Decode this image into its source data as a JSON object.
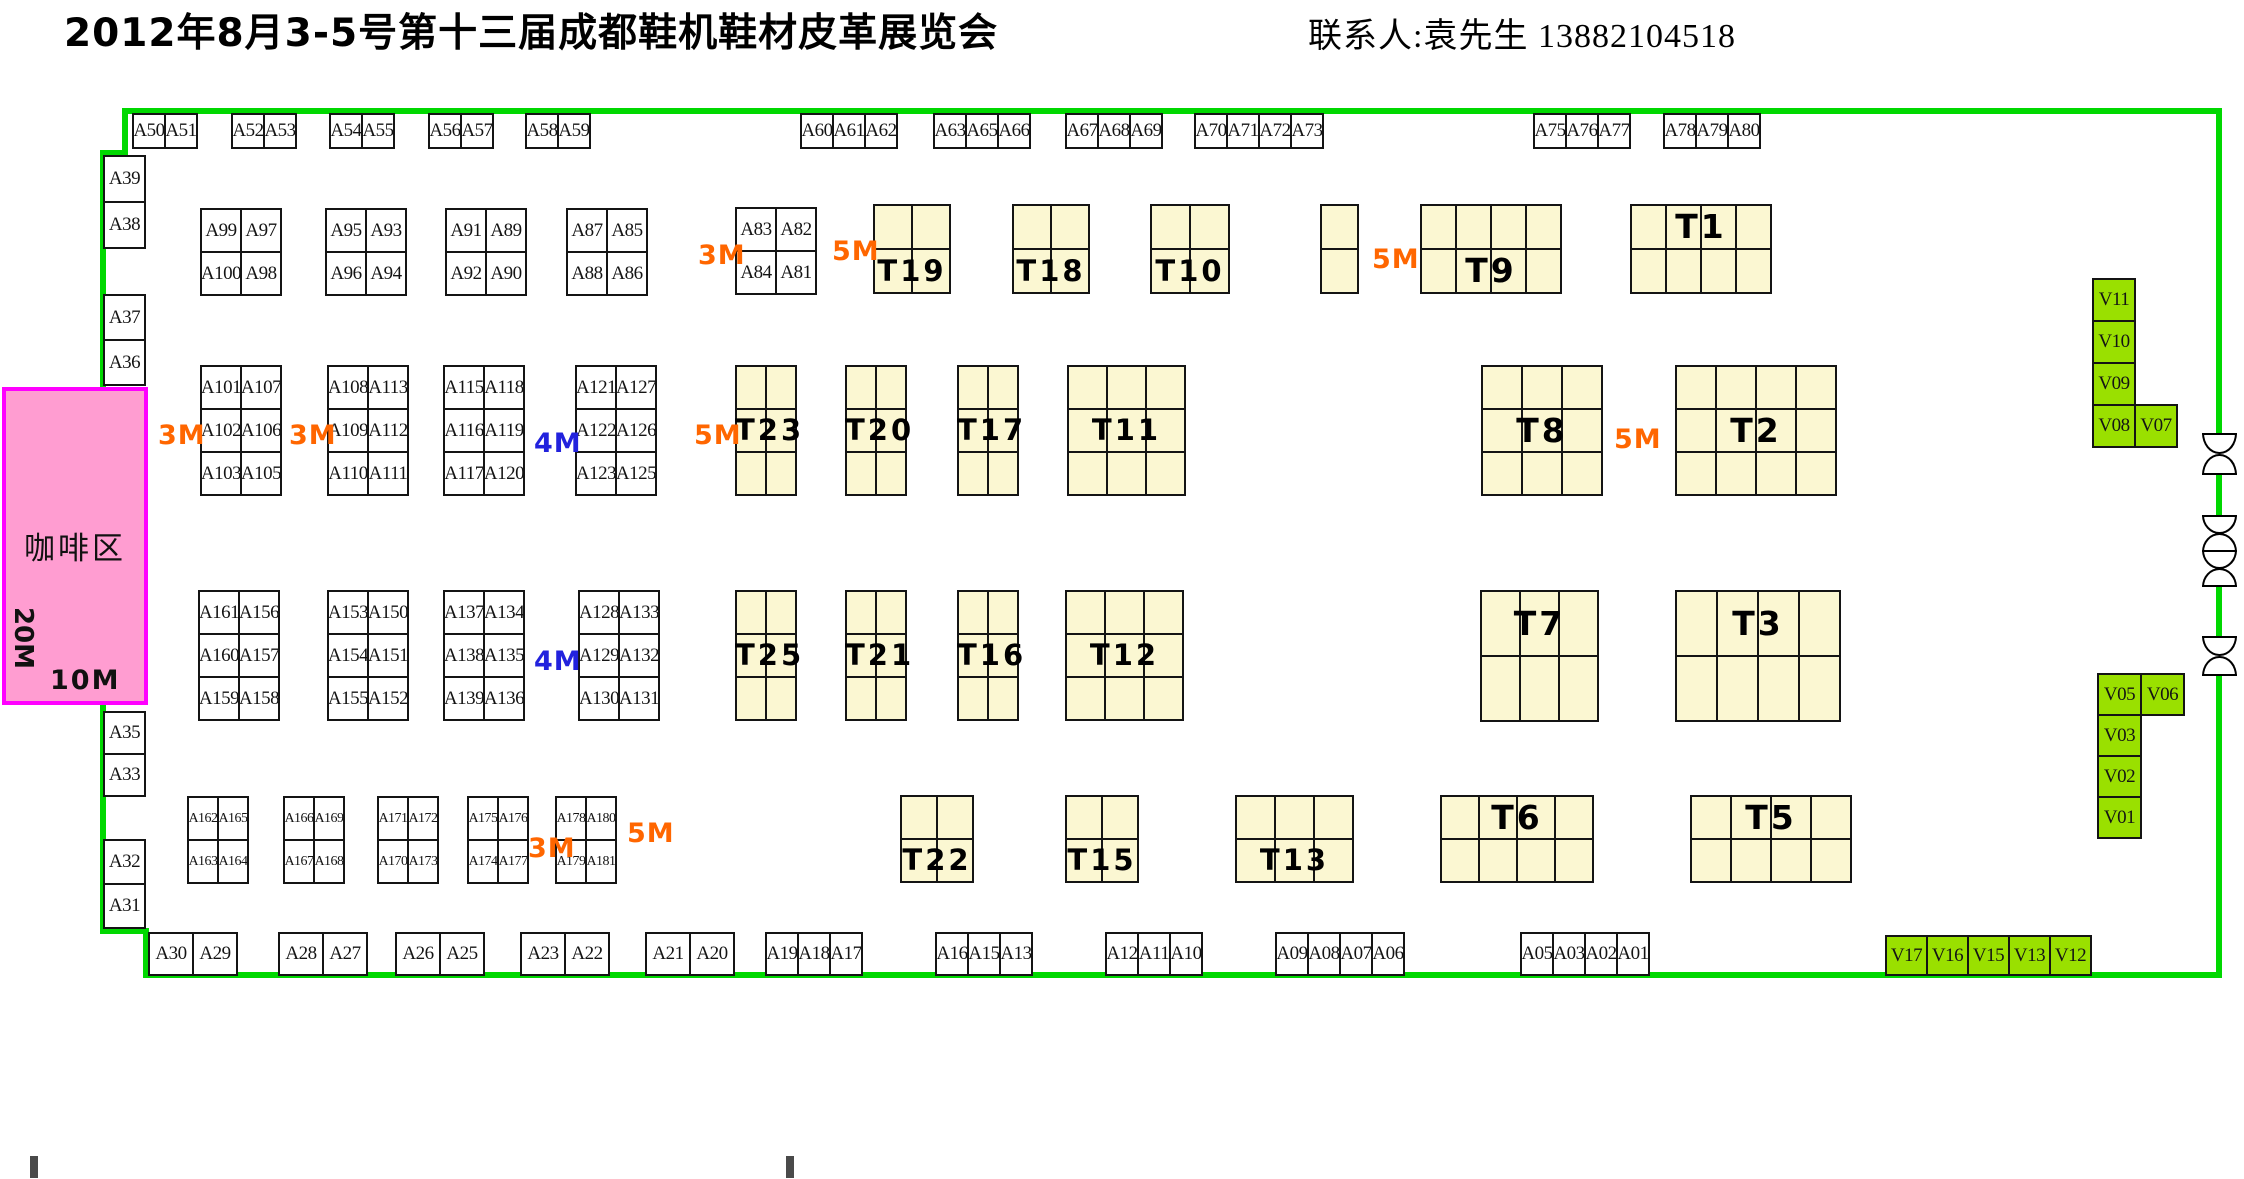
{
  "header": {
    "title": "2012年8月3-5号第十三届成都鞋机鞋材皮革展览会",
    "contact": "联系人:袁先生 13882104518"
  },
  "coffee": {
    "label": "咖啡区",
    "depth": "20M",
    "width": "10M"
  },
  "colors": {
    "boundary_green": "#00D800",
    "t_block_fill": "#FBF7D2",
    "v_booth_fill": "#9AE000",
    "coffee_fill": "#FF9DD1",
    "coffee_border": "#FF00FF",
    "orange": "#FF6600",
    "blue": "#2222DD"
  },
  "groups": [
    {
      "x": 132,
      "y": 113,
      "cw": 34,
      "ch": 36,
      "rows": [
        [
          "A50",
          "A51"
        ]
      ]
    },
    {
      "x": 231,
      "y": 113,
      "cw": 34,
      "ch": 36,
      "rows": [
        [
          "A52",
          "A53"
        ]
      ]
    },
    {
      "x": 329,
      "y": 113,
      "cw": 34,
      "ch": 36,
      "rows": [
        [
          "A54",
          "A55"
        ]
      ]
    },
    {
      "x": 428,
      "y": 113,
      "cw": 34,
      "ch": 36,
      "rows": [
        [
          "A56",
          "A57"
        ]
      ]
    },
    {
      "x": 525,
      "y": 113,
      "cw": 34,
      "ch": 36,
      "rows": [
        [
          "A58",
          "A59"
        ]
      ]
    },
    {
      "x": 800,
      "y": 113,
      "cw": 34,
      "ch": 36,
      "rows": [
        [
          "A60",
          "A61",
          "A62"
        ]
      ]
    },
    {
      "x": 933,
      "y": 113,
      "cw": 34,
      "ch": 36,
      "rows": [
        [
          "A63",
          "A65",
          "A66"
        ]
      ]
    },
    {
      "x": 1065,
      "y": 113,
      "cw": 34,
      "ch": 36,
      "rows": [
        [
          "A67",
          "A68",
          "A69"
        ]
      ]
    },
    {
      "x": 1194,
      "y": 113,
      "cw": 34,
      "ch": 36,
      "rows": [
        [
          "A70",
          "A71",
          "A72",
          "A73"
        ]
      ]
    },
    {
      "x": 1533,
      "y": 113,
      "cw": 34,
      "ch": 36,
      "rows": [
        [
          "A75",
          "A76",
          "A77"
        ]
      ]
    },
    {
      "x": 1663,
      "y": 113,
      "cw": 34,
      "ch": 36,
      "rows": [
        [
          "A78",
          "A79",
          "A80"
        ]
      ]
    },
    {
      "x": 103,
      "y": 155,
      "cw": 43,
      "ch": 48,
      "rows": [
        [
          "A39"
        ]
      ]
    },
    {
      "x": 103,
      "y": 201,
      "cw": 43,
      "ch": 48,
      "rows": [
        [
          "A38"
        ]
      ]
    },
    {
      "x": 103,
      "y": 294,
      "cw": 43,
      "ch": 47,
      "rows": [
        [
          "A37"
        ]
      ]
    },
    {
      "x": 103,
      "y": 339,
      "cw": 43,
      "ch": 47,
      "rows": [
        [
          "A36"
        ]
      ]
    },
    {
      "x": 103,
      "y": 711,
      "cw": 43,
      "ch": 44,
      "rows": [
        [
          "A35"
        ]
      ]
    },
    {
      "x": 103,
      "y": 753,
      "cw": 43,
      "ch": 44,
      "rows": [
        [
          "A33"
        ]
      ]
    },
    {
      "x": 103,
      "y": 839,
      "cw": 43,
      "ch": 46,
      "rows": [
        [
          "A32"
        ]
      ]
    },
    {
      "x": 103,
      "y": 883,
      "cw": 43,
      "ch": 46,
      "rows": [
        [
          "A31"
        ]
      ]
    },
    {
      "x": 200,
      "y": 208,
      "cw": 42,
      "ch": 45,
      "rows": [
        [
          "A99",
          "A97"
        ],
        [
          "A100",
          "A98"
        ]
      ]
    },
    {
      "x": 325,
      "y": 208,
      "cw": 42,
      "ch": 45,
      "rows": [
        [
          "A95",
          "A93"
        ],
        [
          "A96",
          "A94"
        ]
      ]
    },
    {
      "x": 445,
      "y": 208,
      "cw": 42,
      "ch": 45,
      "rows": [
        [
          "A91",
          "A89"
        ],
        [
          "A92",
          "A90"
        ]
      ]
    },
    {
      "x": 566,
      "y": 208,
      "cw": 42,
      "ch": 45,
      "rows": [
        [
          "A87",
          "A85"
        ],
        [
          "A88",
          "A86"
        ]
      ]
    },
    {
      "x": 735,
      "y": 207,
      "cw": 42,
      "ch": 45,
      "rows": [
        [
          "A83",
          "A82"
        ],
        [
          "A84",
          "A81"
        ]
      ]
    },
    {
      "x": 200,
      "y": 365,
      "cw": 42,
      "ch": 45,
      "rows": [
        [
          "A101",
          "A107"
        ],
        [
          "A102",
          "A106"
        ],
        [
          "A103",
          "A105"
        ]
      ]
    },
    {
      "x": 327,
      "y": 365,
      "cw": 42,
      "ch": 45,
      "rows": [
        [
          "A108",
          "A113"
        ],
        [
          "A109",
          "A112"
        ],
        [
          "A110",
          "A111"
        ]
      ]
    },
    {
      "x": 443,
      "y": 365,
      "cw": 42,
      "ch": 45,
      "rows": [
        [
          "A115",
          "A118"
        ],
        [
          "A116",
          "A119"
        ],
        [
          "A117",
          "A120"
        ]
      ]
    },
    {
      "x": 575,
      "y": 365,
      "cw": 42,
      "ch": 45,
      "rows": [
        [
          "A121",
          "A127"
        ],
        [
          "A122",
          "A126"
        ],
        [
          "A123",
          "A125"
        ]
      ]
    },
    {
      "x": 198,
      "y": 590,
      "cw": 42,
      "ch": 45,
      "rows": [
        [
          "A161",
          "A156"
        ],
        [
          "A160",
          "A157"
        ],
        [
          "A159",
          "A158"
        ]
      ]
    },
    {
      "x": 327,
      "y": 590,
      "cw": 42,
      "ch": 45,
      "rows": [
        [
          "A153",
          "A150"
        ],
        [
          "A154",
          "A151"
        ],
        [
          "A155",
          "A152"
        ]
      ]
    },
    {
      "x": 443,
      "y": 590,
      "cw": 42,
      "ch": 45,
      "rows": [
        [
          "A137",
          "A134"
        ],
        [
          "A138",
          "A135"
        ],
        [
          "A139",
          "A136"
        ]
      ]
    },
    {
      "x": 578,
      "y": 590,
      "cw": 42,
      "ch": 45,
      "rows": [
        [
          "A128",
          "A133"
        ],
        [
          "A129",
          "A132"
        ],
        [
          "A130",
          "A131"
        ]
      ]
    },
    {
      "x": 187,
      "y": 796,
      "cw": 32,
      "ch": 45,
      "rows": [
        [
          "A162",
          "A165"
        ],
        [
          "A163",
          "A164"
        ]
      ]
    },
    {
      "x": 283,
      "y": 796,
      "cw": 32,
      "ch": 45,
      "rows": [
        [
          "A166",
          "A169"
        ],
        [
          "A167",
          "A168"
        ]
      ]
    },
    {
      "x": 377,
      "y": 796,
      "cw": 32,
      "ch": 45,
      "rows": [
        [
          "A171",
          "A172"
        ],
        [
          "A170",
          "A173"
        ]
      ]
    },
    {
      "x": 467,
      "y": 796,
      "cw": 32,
      "ch": 45,
      "rows": [
        [
          "A175",
          "A176"
        ],
        [
          "A174",
          "A177"
        ]
      ]
    },
    {
      "x": 555,
      "y": 796,
      "cw": 32,
      "ch": 45,
      "rows": [
        [
          "A178",
          "A180"
        ],
        [
          "A179",
          "A181"
        ]
      ]
    },
    {
      "x": 148,
      "y": 932,
      "cw": 46,
      "ch": 44,
      "rows": [
        [
          "A30",
          "A29"
        ]
      ]
    },
    {
      "x": 278,
      "y": 932,
      "cw": 46,
      "ch": 44,
      "rows": [
        [
          "A28",
          "A27"
        ]
      ]
    },
    {
      "x": 395,
      "y": 932,
      "cw": 46,
      "ch": 44,
      "rows": [
        [
          "A26",
          "A25"
        ]
      ]
    },
    {
      "x": 520,
      "y": 932,
      "cw": 46,
      "ch": 44,
      "rows": [
        [
          "A23",
          "A22"
        ]
      ]
    },
    {
      "x": 645,
      "y": 932,
      "cw": 46,
      "ch": 44,
      "rows": [
        [
          "A21",
          "A20"
        ]
      ]
    },
    {
      "x": 765,
      "y": 932,
      "cw": 34,
      "ch": 44,
      "rows": [
        [
          "A19",
          "A18",
          "A17"
        ]
      ]
    },
    {
      "x": 935,
      "y": 932,
      "cw": 34,
      "ch": 44,
      "rows": [
        [
          "A16",
          "A15",
          "A13"
        ]
      ]
    },
    {
      "x": 1105,
      "y": 932,
      "cw": 34,
      "ch": 44,
      "rows": [
        [
          "A12",
          "A11",
          "A10"
        ]
      ]
    },
    {
      "x": 1275,
      "y": 932,
      "cw": 34,
      "ch": 44,
      "rows": [
        [
          "A09",
          "A08",
          "A07",
          "A06"
        ]
      ]
    },
    {
      "x": 1520,
      "y": 932,
      "cw": 34,
      "ch": 44,
      "rows": [
        [
          "A05",
          "A03",
          "A02",
          "A01"
        ]
      ]
    },
    {
      "x": 2092,
      "y": 278,
      "cw": 44,
      "ch": 44,
      "v": 1,
      "rows": [
        [
          "V11"
        ],
        [
          "V10"
        ],
        [
          "V09"
        ]
      ]
    },
    {
      "x": 2092,
      "y": 404,
      "cw": 44,
      "ch": 44,
      "v": 1,
      "rows": [
        [
          "V08",
          "V07"
        ]
      ]
    },
    {
      "x": 2097,
      "y": 673,
      "cw": 45,
      "ch": 43,
      "v": 1,
      "rows": [
        [
          "V05",
          "V06"
        ]
      ]
    },
    {
      "x": 2097,
      "y": 714,
      "cw": 45,
      "ch": 43,
      "v": 1,
      "rows": [
        [
          "V03"
        ],
        [
          "V02"
        ],
        [
          "V01"
        ]
      ]
    },
    {
      "x": 1885,
      "y": 935,
      "cw": 43,
      "ch": 41,
      "v": 1,
      "rows": [
        [
          "V17",
          "V16",
          "V15",
          "V13",
          "V12"
        ]
      ]
    }
  ],
  "t_blocks": [
    {
      "x": 873,
      "y": 204,
      "cols": 2,
      "rows": 2,
      "cw": 40,
      "ch": 46,
      "label": "T19",
      "lr": 1
    },
    {
      "x": 1012,
      "y": 204,
      "cols": 2,
      "rows": 2,
      "cw": 40,
      "ch": 46,
      "label": "T18",
      "lr": 1
    },
    {
      "x": 1150,
      "y": 204,
      "cols": 2,
      "rows": 2,
      "cw": 41,
      "ch": 46,
      "label": "T10",
      "lr": 1
    },
    {
      "x": 1320,
      "y": 204,
      "cols": 1,
      "rows": 2,
      "cw": 39,
      "ch": 46,
      "label": "",
      "lr": 0
    },
    {
      "x": 1420,
      "y": 204,
      "cols": 4,
      "rows": 2,
      "cw": 37,
      "ch": 46,
      "label": "T9",
      "lr": 1
    },
    {
      "x": 1630,
      "y": 204,
      "cols": 4,
      "rows": 2,
      "cw": 37,
      "ch": 46,
      "label": "T1",
      "lr": 0
    },
    {
      "x": 735,
      "y": 365,
      "cols": 2,
      "rows": 3,
      "cw": 32,
      "ch": 45,
      "label": "T23",
      "lr": 1
    },
    {
      "x": 845,
      "y": 365,
      "cols": 2,
      "rows": 3,
      "cw": 32,
      "ch": 45,
      "label": "T20",
      "lr": 1
    },
    {
      "x": 957,
      "y": 365,
      "cols": 2,
      "rows": 3,
      "cw": 32,
      "ch": 45,
      "label": "T17",
      "lr": 1
    },
    {
      "x": 1067,
      "y": 365,
      "cols": 3,
      "rows": 3,
      "cw": 41,
      "ch": 45,
      "label": "T11",
      "lr": 1
    },
    {
      "x": 1481,
      "y": 365,
      "cols": 3,
      "rows": 3,
      "cw": 42,
      "ch": 45,
      "label": "T8",
      "lr": 1
    },
    {
      "x": 1675,
      "y": 365,
      "cols": 4,
      "rows": 3,
      "cw": 42,
      "ch": 45,
      "label": "T2",
      "lr": 1
    },
    {
      "x": 735,
      "y": 590,
      "cols": 2,
      "rows": 3,
      "cw": 32,
      "ch": 45,
      "label": "T25",
      "lr": 1
    },
    {
      "x": 845,
      "y": 590,
      "cols": 2,
      "rows": 3,
      "cw": 32,
      "ch": 45,
      "label": "T21",
      "lr": 1
    },
    {
      "x": 957,
      "y": 590,
      "cols": 2,
      "rows": 3,
      "cw": 32,
      "ch": 45,
      "label": "T16",
      "lr": 1
    },
    {
      "x": 1065,
      "y": 590,
      "cols": 3,
      "rows": 3,
      "cw": 41,
      "ch": 45,
      "label": "T12",
      "lr": 1
    },
    {
      "x": 1480,
      "y": 590,
      "cols": 3,
      "rows": 2,
      "cw": 41,
      "ch": 67,
      "label": "T7",
      "lr": 0
    },
    {
      "x": 1675,
      "y": 590,
      "cols": 4,
      "rows": 2,
      "cw": 43,
      "ch": 67,
      "label": "T3",
      "lr": 0
    },
    {
      "x": 900,
      "y": 795,
      "cols": 2,
      "rows": 2,
      "cw": 38,
      "ch": 45,
      "label": "T22",
      "lr": 1
    },
    {
      "x": 1065,
      "y": 795,
      "cols": 2,
      "rows": 2,
      "cw": 38,
      "ch": 45,
      "label": "T15",
      "lr": 1
    },
    {
      "x": 1235,
      "y": 795,
      "cols": 3,
      "rows": 2,
      "cw": 41,
      "ch": 45,
      "label": "T13",
      "lr": 1
    },
    {
      "x": 1440,
      "y": 795,
      "cols": 4,
      "rows": 2,
      "cw": 40,
      "ch": 45,
      "label": "T6",
      "lr": 0
    },
    {
      "x": 1690,
      "y": 795,
      "cols": 4,
      "rows": 2,
      "cw": 42,
      "ch": 45,
      "label": "T5",
      "lr": 0
    }
  ],
  "dims": [
    {
      "t": "3M",
      "x": 698,
      "y": 240,
      "c": "o"
    },
    {
      "t": "5M",
      "x": 832,
      "y": 236,
      "c": "o"
    },
    {
      "t": "5M",
      "x": 1372,
      "y": 244,
      "c": "o"
    },
    {
      "t": "3M",
      "x": 158,
      "y": 420,
      "c": "o"
    },
    {
      "t": "3M",
      "x": 289,
      "y": 420,
      "c": "o"
    },
    {
      "t": "4M",
      "x": 534,
      "y": 428,
      "c": "b"
    },
    {
      "t": "5M",
      "x": 694,
      "y": 420,
      "c": "o"
    },
    {
      "t": "5M",
      "x": 1614,
      "y": 424,
      "c": "o"
    },
    {
      "t": "4M",
      "x": 534,
      "y": 646,
      "c": "b"
    },
    {
      "t": "3M",
      "x": 528,
      "y": 833,
      "c": "o"
    },
    {
      "t": "5M",
      "x": 627,
      "y": 818,
      "c": "o"
    }
  ],
  "boundary": [
    {
      "x": 122,
      "y": 108,
      "w": 2100,
      "h": 6
    },
    {
      "x": 122,
      "y": 108,
      "w": 6,
      "h": 48
    },
    {
      "x": 100,
      "y": 150,
      "w": 28,
      "h": 6
    },
    {
      "x": 100,
      "y": 150,
      "w": 6,
      "h": 784
    },
    {
      "x": 100,
      "y": 928,
      "w": 48,
      "h": 6
    },
    {
      "x": 143,
      "y": 928,
      "w": 6,
      "h": 50
    },
    {
      "x": 143,
      "y": 972,
      "w": 2079,
      "h": 6
    },
    {
      "x": 2216,
      "y": 108,
      "w": 6,
      "h": 327
    },
    {
      "x": 2216,
      "y": 475,
      "w": 6,
      "h": 42
    },
    {
      "x": 2216,
      "y": 587,
      "w": 6,
      "h": 51
    },
    {
      "x": 2216,
      "y": 676,
      "w": 6,
      "h": 300
    }
  ],
  "doors": [
    {
      "y": 433,
      "h": 42
    },
    {
      "y": 515,
      "h": 37
    },
    {
      "y": 550,
      "h": 37
    },
    {
      "y": 636,
      "h": 40
    }
  ],
  "marks": [
    {
      "x": 30,
      "y": 1156,
      "w": 8,
      "h": 22
    },
    {
      "x": 786,
      "y": 1156,
      "w": 8,
      "h": 22
    }
  ]
}
